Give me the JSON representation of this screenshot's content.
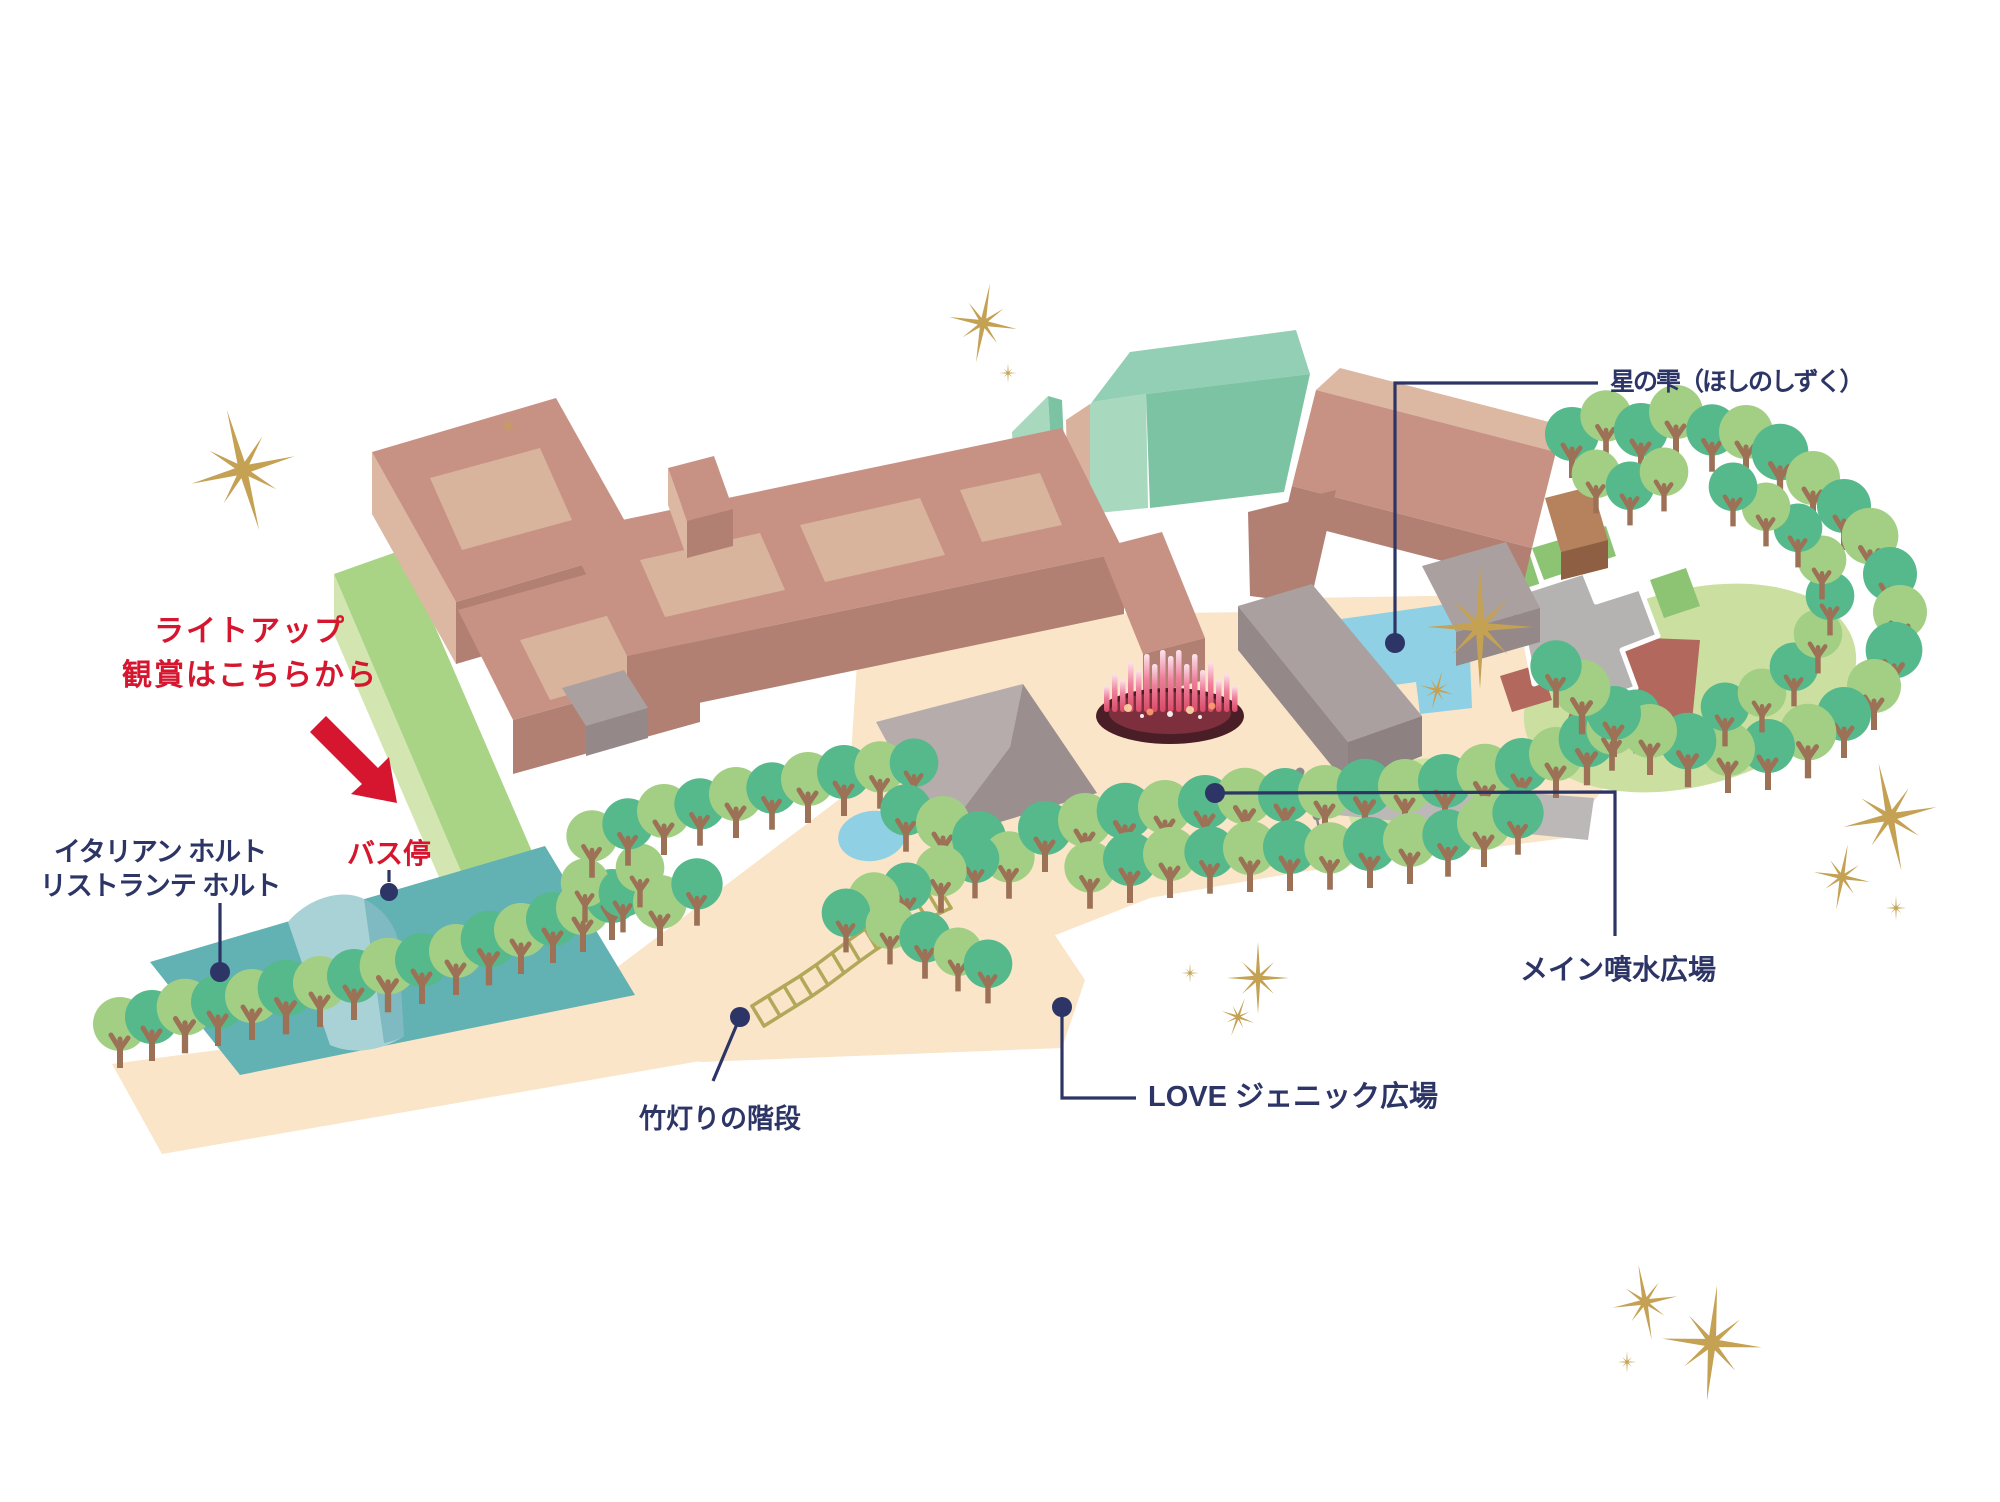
{
  "map_title": "park-illumination-guide-map",
  "labels": {
    "hoshi_no_shizuku": "星の雫（ほしのしずく）",
    "lightup_line1": "ライトアップ",
    "lightup_line2": "観賞はこちらから",
    "italian_line1": "イタリアン ホルト",
    "italian_line2": "リストランテ ホルト",
    "bus_stop": "バス停",
    "bamboo_stairs": "竹灯りの階段",
    "love_plaza": "LOVE ジェニック広場",
    "main_fountain_plaza": "メイン噴水広場"
  },
  "colors": {
    "label_navy": "#2c3565",
    "accent_red": "#d5162e",
    "sparkle_gold": "#c4a153",
    "building_salmon": "#c79284",
    "building_salmon_top": "#dcb7a1",
    "building_salmon_front": "#b28073",
    "building_mint": "#7cc3a3",
    "building_mint_light": "#a8d8bd",
    "restaurant_teal": "#62b1b3",
    "restaurant_teal_light": "#a9d2d6",
    "path_peach": "#fae5c8",
    "pond_blue": "#8fd0e4",
    "lawn_green": "#cde4a4",
    "tree_green_dark": "#55b98b",
    "tree_green_light": "#a3cf85",
    "tree_trunk": "#9c7156",
    "gray_building": "#a89c9c",
    "plaza_gray": "#b5b2b2",
    "terracotta": "#b2685c",
    "stairs_olive": "#b2a85a",
    "fountain_pink": "#e75b7e"
  }
}
